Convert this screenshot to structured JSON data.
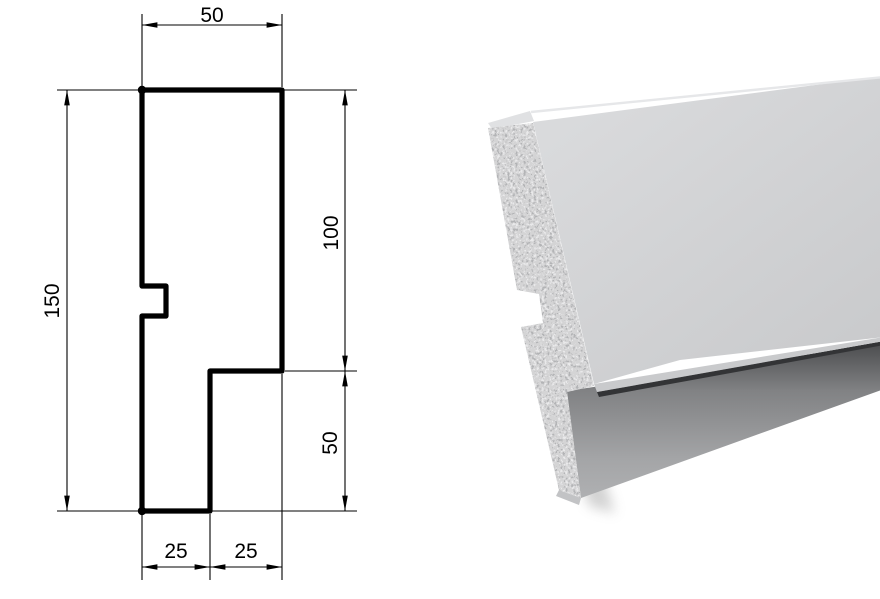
{
  "figure": {
    "title": "facade-profile-cross-section",
    "dimension_labels": {
      "top_width": "50",
      "left_height": "150",
      "right_upper": "100",
      "right_lower": "50",
      "bottom_left": "25",
      "bottom_right": "25"
    },
    "line_color": "#000000"
  },
  "render3d": {
    "colors": {
      "top_face": "#e0e1e3",
      "top_edge_highlight": "#e6e7e9",
      "front_light": "#d9dadc",
      "front_dark": "#c9cacc",
      "under_strip": "#c9cacc",
      "crease": "#333436",
      "lower_dark": "#4a4b4d",
      "lower_mid1": "#818284",
      "lower_mid2": "#a4a5a7",
      "lower_light": "#b1b2b4",
      "cut_face": "#b3b4b6",
      "cut_edge": "#a6a7a9",
      "bottom_sliver": "#c2c3c5",
      "shadow": "#9b9b9b"
    }
  }
}
